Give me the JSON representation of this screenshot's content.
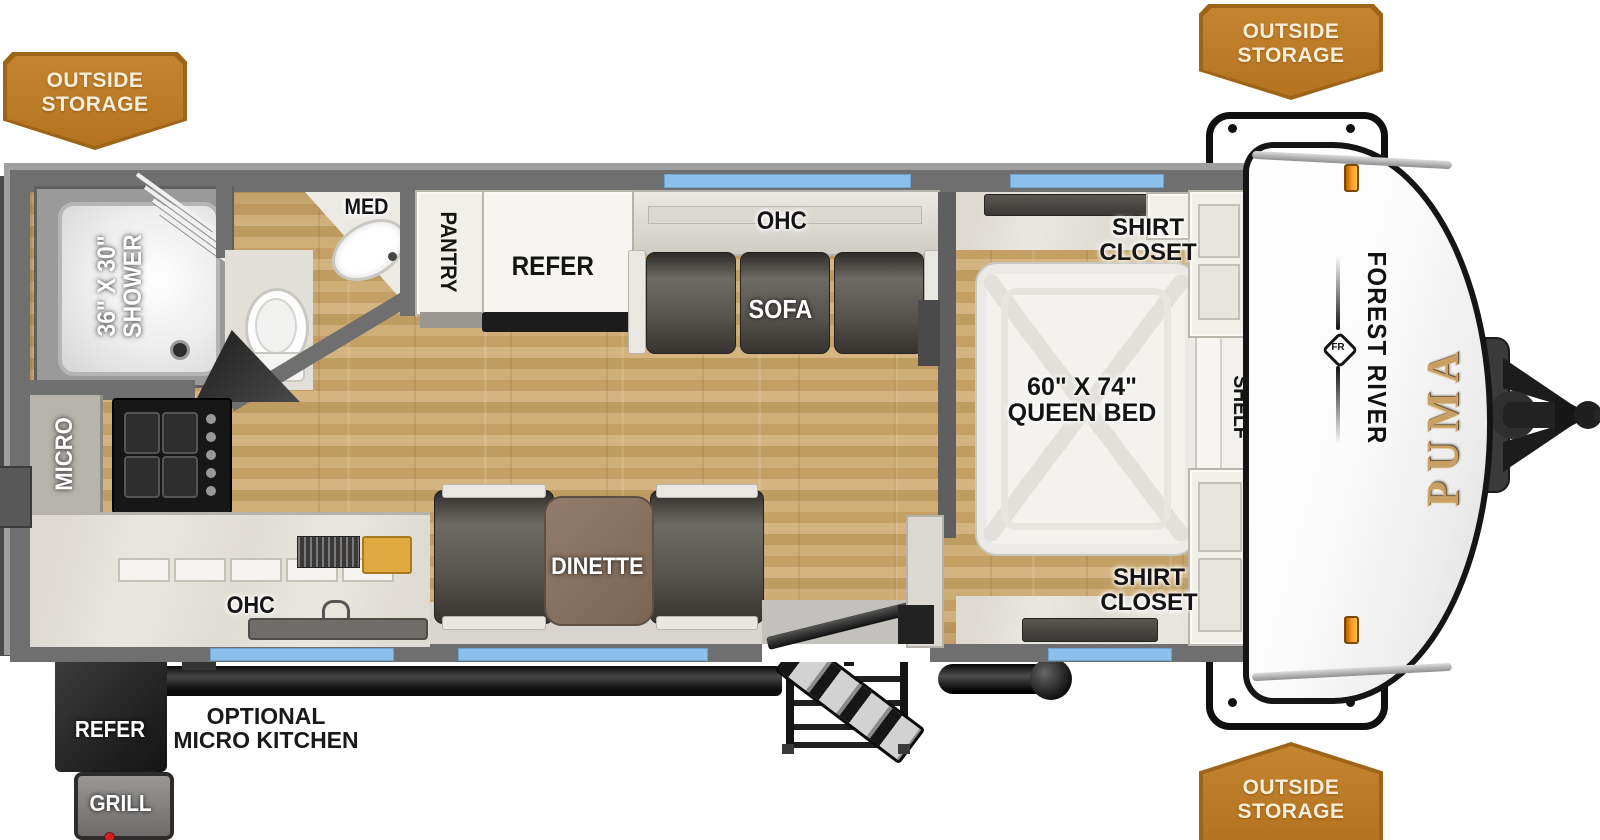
{
  "badges": {
    "top_left": "OUTSIDE STORAGE",
    "top_right": "OUTSIDE STORAGE",
    "bottom_right": "OUTSIDE STORAGE"
  },
  "branding": {
    "make": "FOREST RIVER",
    "model": "PUMA",
    "logo_monogram": "FR"
  },
  "bathroom": {
    "shower_size": "36\" X 30\"",
    "shower": "SHOWER",
    "med": "MED"
  },
  "kitchen": {
    "micro": "MICRO",
    "ohc": "OHC",
    "pantry": "PANTRY",
    "refer": "REFER"
  },
  "living": {
    "ohc": "OHC",
    "sofa": "SOFA",
    "dinette": "DINETTE"
  },
  "bedroom": {
    "shirt_closet_top": "SHIRT CLOSET",
    "shirt_closet_bottom": "SHIRT CLOSET",
    "bed_size": "60\" X 74\"",
    "bed": "QUEEN BED",
    "shelf": "SHELF"
  },
  "exterior": {
    "optional_kitchen": "OPTIONAL MICRO KITCHEN",
    "refer": "REFER",
    "grill": "GRILL"
  },
  "colors": {
    "badge_orange": "#bf7c2a",
    "window_blue": "#8cc0ec",
    "wall_gray": "#6f6f6f",
    "wood_tan": "#c7a46c",
    "puma_gold": "#c9a063",
    "marker_orange": "#f79420"
  }
}
